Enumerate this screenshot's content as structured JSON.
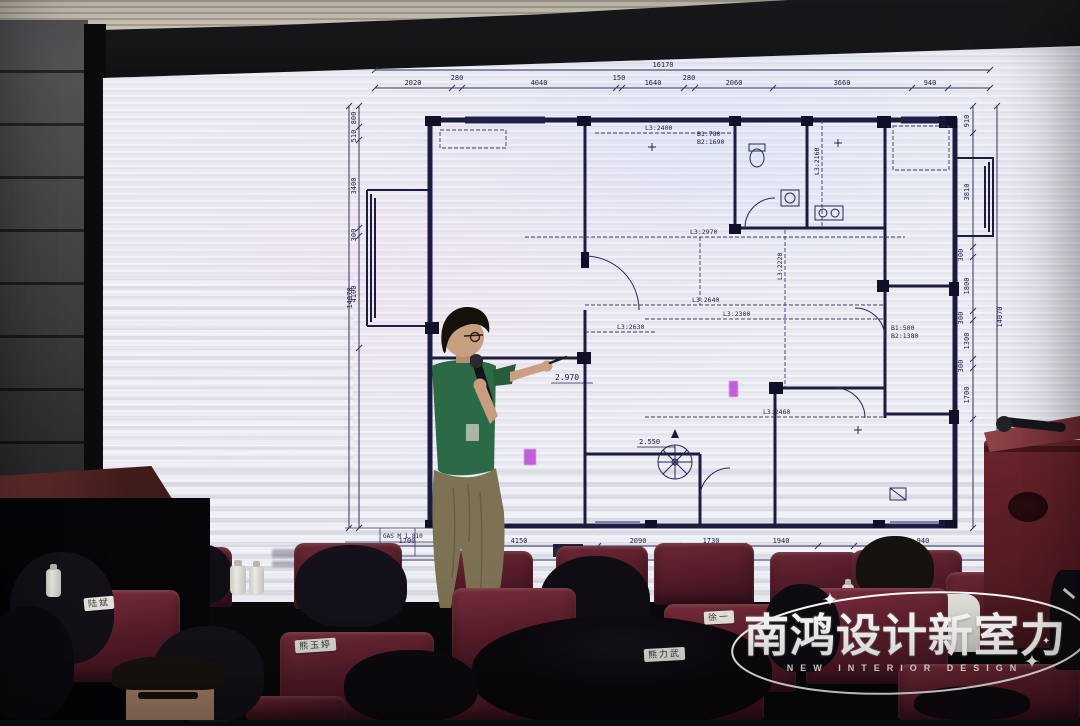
{
  "logo": {
    "title": "南鸿设计新室力",
    "subtitle": "NEW INTERIOR DESIGN",
    "sparkle": "✦"
  },
  "audience": {
    "seat_labels": [
      "陆斌",
      "熊玉婷",
      "徐一",
      "熊力武"
    ]
  },
  "plan": {
    "top_total": "16170",
    "top_dims": [
      "2020",
      "280",
      "4040",
      "150",
      "1640",
      "280",
      "2060",
      "3660",
      "940"
    ],
    "right_total": "14070",
    "right_dims": [
      "910",
      "3810",
      "300",
      "1800",
      "300",
      "1300",
      "300",
      "1700"
    ],
    "left_total": "14070",
    "left_dims": [
      "800",
      "510",
      "3400",
      "300",
      "4100"
    ],
    "bottom_total": "16170",
    "bottom_dims": [
      "1700",
      "4150",
      "2090",
      "1730",
      "1940",
      "940"
    ],
    "labels": {
      "l1": "L3:2970",
      "l2": "L3:2640",
      "l3": "L3:2220",
      "l4": "L3:2300",
      "l5": "L3:2460",
      "l6": "L3:2630",
      "l7": "L3:2160",
      "l8": "L3:2400",
      "b1a": "B1:900",
      "b1b": "B2:1670",
      "b2a": "B1:780",
      "b2b": "B2:1690",
      "b3a": "B1:500",
      "b3b": "B2:1380",
      "e1": "2.970",
      "e2": "2.550",
      "gas": "GAS M 1.810"
    }
  }
}
